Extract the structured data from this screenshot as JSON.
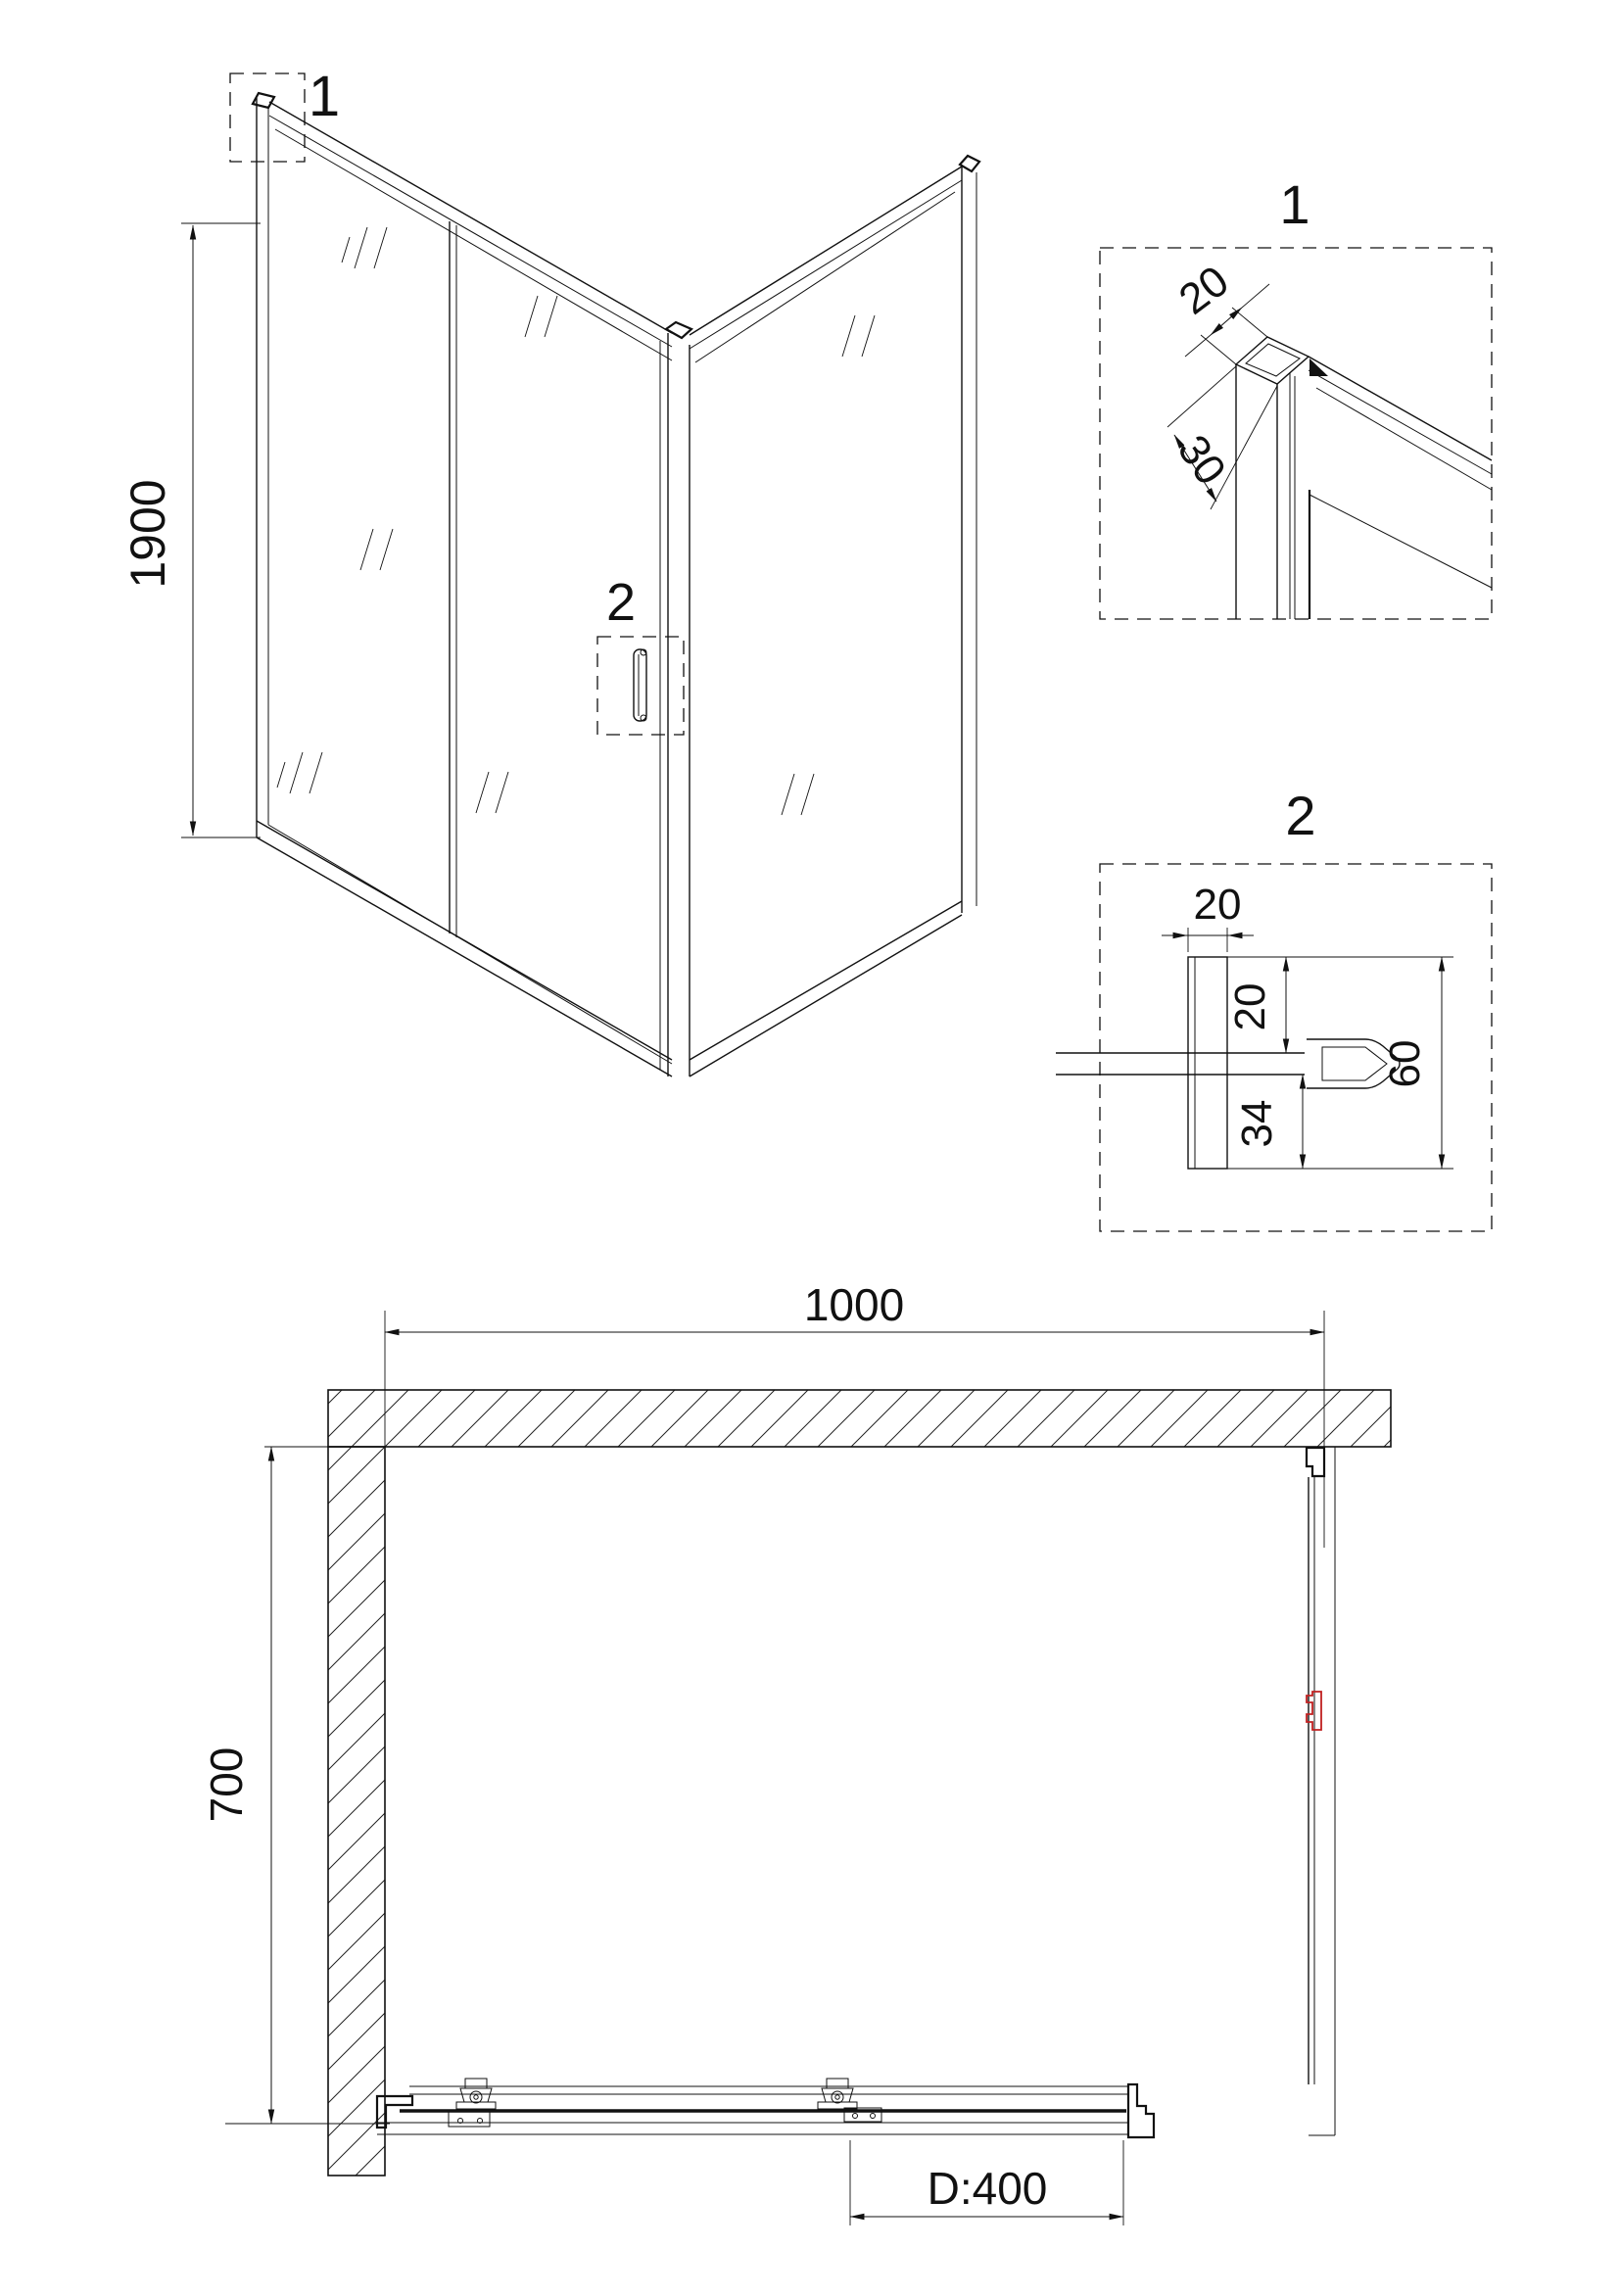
{
  "iso": {
    "height": "1900",
    "callout1": "1",
    "callout2": "2"
  },
  "detail1": {
    "title": "1",
    "dimA": "20",
    "dimB": "30"
  },
  "detail2": {
    "title": "2",
    "dimTop": "20",
    "dimGap": "20",
    "dimLower": "34",
    "dimTotal": "60"
  },
  "plan": {
    "width": "1000",
    "depth": "700",
    "door": "D:400"
  },
  "colors": {
    "line": "#111111",
    "red": "#c02020",
    "background": "#ffffff"
  }
}
